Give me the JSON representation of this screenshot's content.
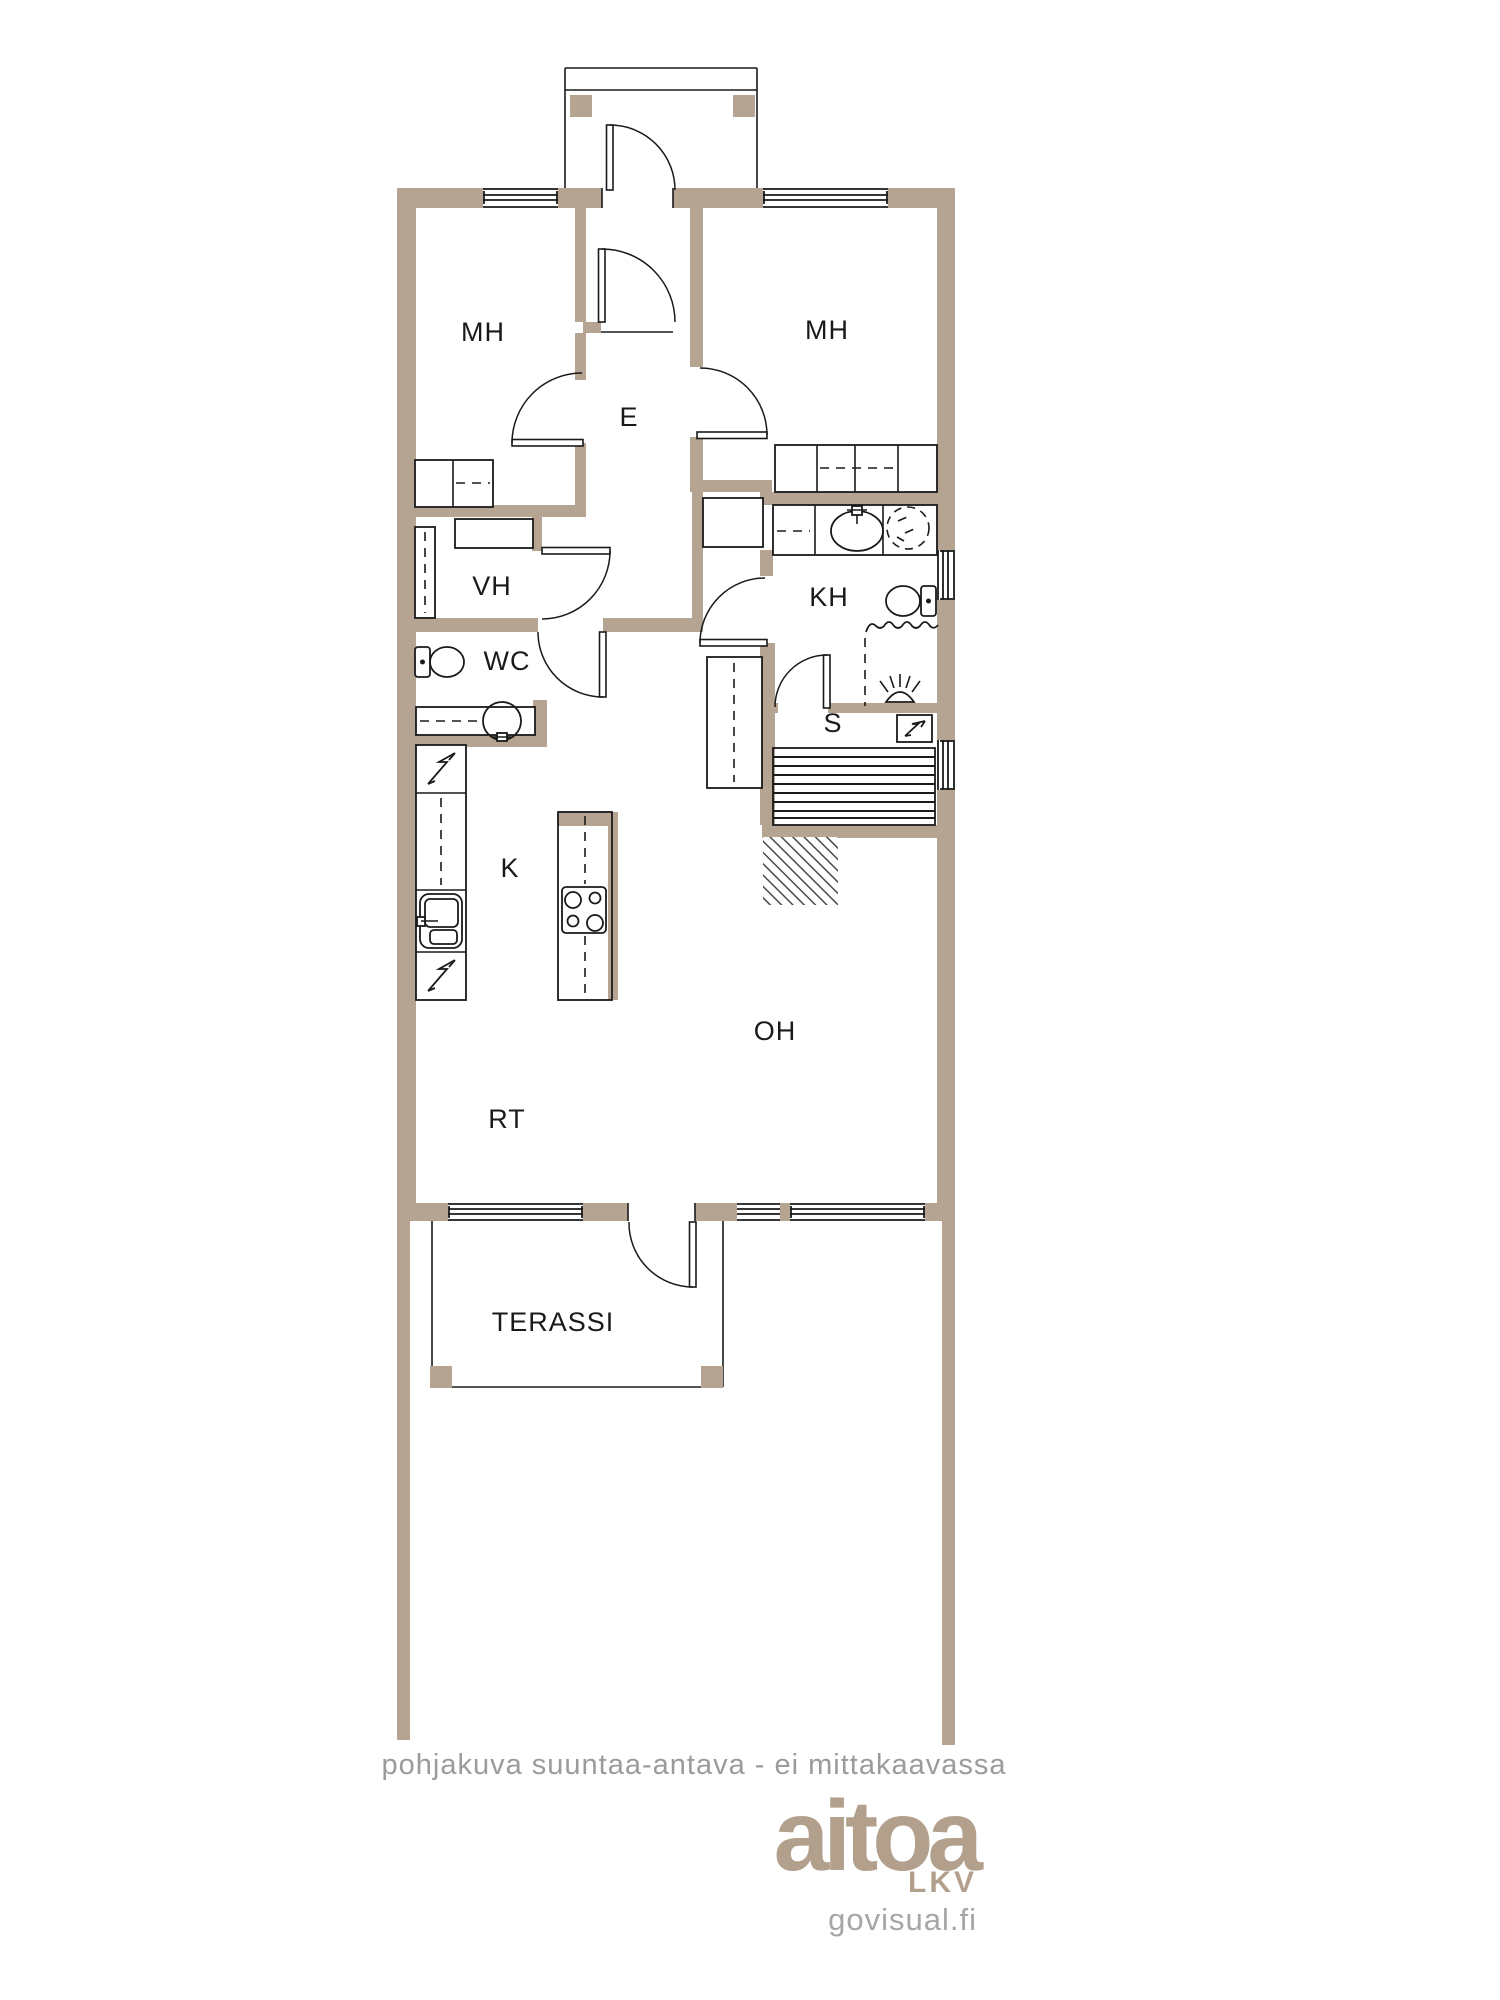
{
  "rooms": [
    {
      "id": "mh-left",
      "label": "MH"
    },
    {
      "id": "mh-right",
      "label": "MH"
    },
    {
      "id": "e",
      "label": "E"
    },
    {
      "id": "vh",
      "label": "VH"
    },
    {
      "id": "wc",
      "label": "WC"
    },
    {
      "id": "kh",
      "label": "KH"
    },
    {
      "id": "s",
      "label": "S"
    },
    {
      "id": "k",
      "label": "K"
    },
    {
      "id": "oh",
      "label": "OH"
    },
    {
      "id": "rt",
      "label": "RT"
    },
    {
      "id": "terassi",
      "label": "TERASSI"
    }
  ],
  "footer": {
    "note": "pohjakuva suuntaa-antava - ei mittakaavassa"
  },
  "logo": {
    "brand": "aitoa",
    "division": "LKV",
    "website": "govisual.fi"
  },
  "colors": {
    "wall": "#b5a491",
    "line": "#1a1a1a",
    "note": "#9b9b9b",
    "logo": "#b2a08d",
    "website": "#a6a6a6"
  },
  "icons": {
    "fixtures": [
      "toilet-icon",
      "sink-icon",
      "washing-machine-icon",
      "shower-head-icon",
      "stove-icon",
      "fridge-electric-icon",
      "dishwasher-electric-icon",
      "sauna-heater-icon",
      "sauna-bench-icon"
    ]
  }
}
